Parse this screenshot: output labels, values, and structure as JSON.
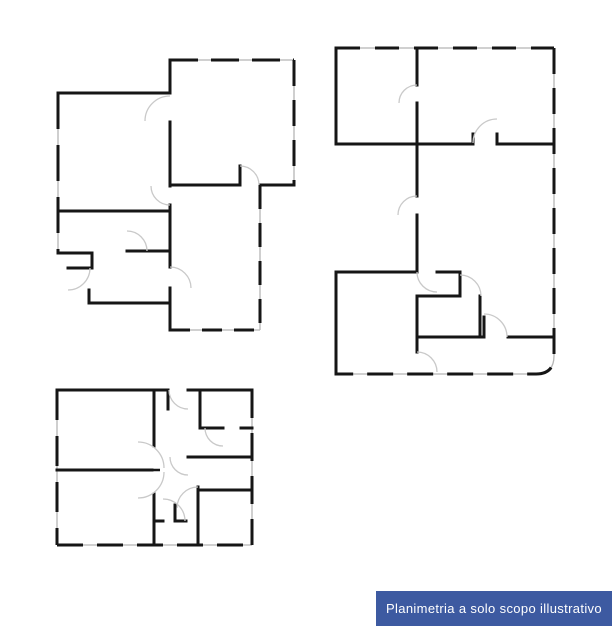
{
  "banner": {
    "label": "Planimetria a solo scopo illustrativo",
    "bg_color": "#3d5aa1",
    "text_color": "#ffffff"
  },
  "drawing": {
    "background": "#ffffff",
    "wall_color": "#161616",
    "window_color": "#b5b5b5",
    "door_arc_color": "#c9c9c9",
    "plans": [
      {
        "id": "plan-upper-left",
        "walls": [
          "M58,93 H170",
          "M170,93 V60",
          "M260,185 H294",
          "M170,330 V303",
          "M89,303 H170",
          "M89,290 V303",
          "M68,268 H92",
          "M92,253 V268",
          "M58,253 H92",
          "M170,122 V186",
          "M170,205 V267",
          "M170,288 V330",
          "M170,185 H240",
          "M240,166 V185",
          "M58,211 H170",
          "M127,251 H170"
        ],
        "window_walls": [
          {
            "d": "M170,60 H294",
            "dash": "28 13"
          },
          {
            "d": "M294,60 V185",
            "dash": "26 14"
          },
          {
            "d": "M260,185 V330",
            "dash": "24 14"
          },
          {
            "d": "M170,330 H260",
            "dash": "20 12"
          },
          {
            "d": "M58,93 V253",
            "dash": "36 16"
          }
        ],
        "door_arcs": [
          "M145,121 A25,25 0 0 1 170,96",
          "M240,166 A19,19 0 0 1 259,185",
          "M151,186 A19,19 0 0 0 170,205",
          "M127,231 A20,20 0 0 1 147,251",
          "M170,267 A21,21 0 0 1 191,288",
          "M90,268 A22,22 0 0 1 68,290"
        ],
        "door_leaves": []
      },
      {
        "id": "plan-right",
        "walls": [
          "M336,48 V144",
          "M336,144 H473",
          "M497,144 H554",
          "M336,272 V374",
          "M336,272 H417",
          "M417,48 V85",
          "M417,103 V196",
          "M417,215 V272",
          "M437,272 H460",
          "M460,272 V296",
          "M417,296 H460",
          "M417,296 V352",
          "M417,337 H484",
          "M480,296 V337",
          "M484,317 V337",
          "M508,337 H554",
          "M473,134 V144",
          "M497,134 V144"
        ],
        "window_walls": [
          {
            "d": "M336,48 H554",
            "dash": "24 15"
          },
          {
            "d": "M554,48 V356 Q554,374 536,374 H336",
            "dash": "26 14"
          }
        ],
        "door_arcs": [
          "M399,103 A18,18 0 0 1 417,85",
          "M398,215 A19,19 0 0 1 417,196",
          "M417,272 A20,20 0 0 0 437,292",
          "M460,275 A21,21 0 0 1 481,296",
          "M484,314 A23,23 0 0 1 507,337",
          "M473,143 A24,24 0 0 1 497,119",
          "M417,352 A20,20 0 0 1 437,372"
        ],
        "door_leaves": []
      },
      {
        "id": "plan-lower-left",
        "walls": [
          "M57,390 H168",
          "M188,390 H252",
          "M154,390 V446",
          "M154,494 V545",
          "M57,470 H152",
          "M200,390 V428",
          "M200,428 H223",
          "M241,428 H252",
          "M188,457 H252",
          "M198,490 H252",
          "M198,487 V545",
          "M175,505 V521",
          "M154,521 H163",
          "M175,521 H186",
          "M168,390 V409"
        ],
        "window_walls": [
          {
            "d": "M57,390 V545",
            "dash": "30 16"
          },
          {
            "d": "M57,545 H252",
            "dash": "26 14"
          },
          {
            "d": "M252,390 V545",
            "dash": "28 15"
          }
        ],
        "door_arcs": [
          "M169,390 A19,19 0 0 0 188,409",
          "M205,428 A18,18 0 0 0 223,446",
          "M170,457 A18,18 0 0 0 188,475",
          "M177,508 A21,21 0 0 1 198,487",
          "M163,499 A22,22 0 0 1 185,521",
          "M138,442 A26,26 0 0 1 164,468",
          "M138,498 A26,26 0 0 0 164,472"
        ],
        "door_leaves": [
          "M136,470 H160"
        ]
      }
    ]
  }
}
